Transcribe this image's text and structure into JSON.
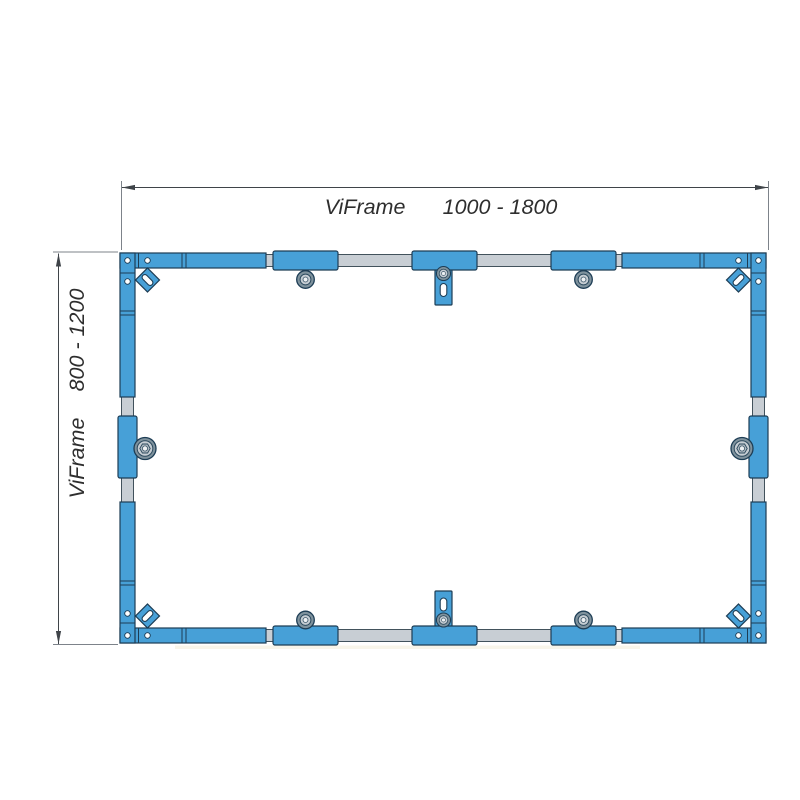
{
  "diagram": {
    "type": "technical-drawing",
    "product": "ViFrame",
    "width_dimension": {
      "label": "ViFrame",
      "range": "1000 - 1800"
    },
    "height_dimension": {
      "label": "ViFrame",
      "range": "800 - 1200"
    }
  },
  "colors": {
    "background": "#ffffff",
    "profile_blue": "#47a0d7",
    "profile_outline": "#1d3d55",
    "connector_gray": "#c8ced4",
    "connector_outline": "#42525c",
    "bolt_dark": "#7f929d",
    "bolt_mid": "#c6cdd3",
    "bolt_hex": "#b0bac1",
    "bolt_center": "#eef1f3",
    "dimension_line": "#3f4449",
    "extension_line": "#7d838a",
    "text": "#2e2e2e"
  }
}
